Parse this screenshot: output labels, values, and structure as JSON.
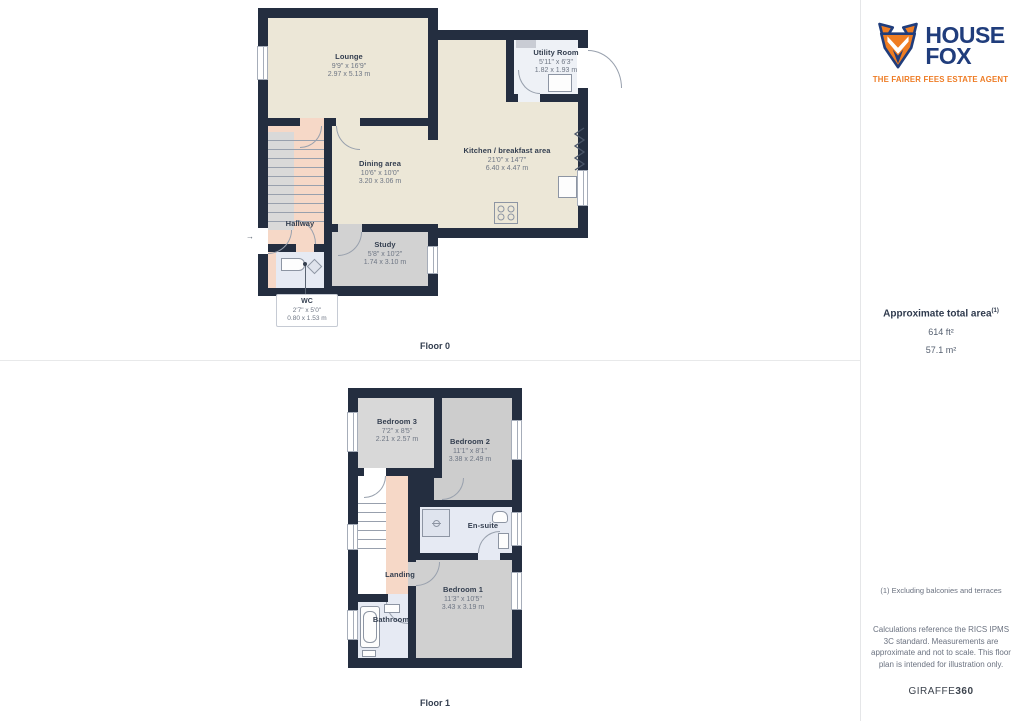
{
  "branding": {
    "logo_line1": "HOUSE",
    "logo_line2": "FOX",
    "tagline": "THE FAIRER FEES ESTATE AGENT"
  },
  "sidebar": {
    "total_area_title": "Approximate total area",
    "total_area_superscript": "(1)",
    "total_area_imperial": "614 ft²",
    "total_area_metric": "57.1 m²",
    "footnote": "(1) Excluding balconies and terraces",
    "disclaimer": "Calculations reference the RICS IPMS 3C standard. Measurements are approximate and not to scale. This floor plan is intended for illustration only.",
    "provider_normal": "GIRAFFE",
    "provider_bold": "360"
  },
  "floors": [
    {
      "label": "Floor 0",
      "rooms": [
        {
          "name": "Lounge",
          "imperial": "9'9\" x 16'9\"",
          "metric": "2.97 x 5.13 m"
        },
        {
          "name": "Utility Room",
          "imperial": "5'11\" x 6'3\"",
          "metric": "1.82 x 1.93 m"
        },
        {
          "name": "Kitchen / breakfast area",
          "imperial": "21'0\" x 14'7\"",
          "metric": "6.40 x 4.47 m"
        },
        {
          "name": "Dining area",
          "imperial": "10'6\" x 10'0\"",
          "metric": "3.20 x 3.06 m"
        },
        {
          "name": "Hallway"
        },
        {
          "name": "Study",
          "imperial": "5'8\" x 10'2\"",
          "metric": "1.74 x 3.10 m"
        },
        {
          "name": "WC",
          "imperial": "2'7\" x 5'0\"",
          "metric": "0.80 x 1.53 m"
        }
      ]
    },
    {
      "label": "Floor 1",
      "rooms": [
        {
          "name": "Bedroom 3",
          "imperial": "7'2\" x 8'5\"",
          "metric": "2.21 x 2.57 m"
        },
        {
          "name": "Bedroom 2",
          "imperial": "11'1\" x 8'1\"",
          "metric": "3.38 x 2.49 m"
        },
        {
          "name": "En-suite"
        },
        {
          "name": "Landing"
        },
        {
          "name": "Bedroom 1",
          "imperial": "11'3\" x 10'5\"",
          "metric": "3.43 x 3.19 m"
        },
        {
          "name": "Bathroom"
        }
      ]
    }
  ],
  "colors": {
    "wall": "#242e40",
    "cream_room": "#ece7d7",
    "salmon_room": "#f6d8c7",
    "gray_room": "#d2d2d2",
    "blue_room": "#e6eaf3",
    "brand_navy": "#203d7c",
    "brand_orange": "#ee7c25"
  }
}
